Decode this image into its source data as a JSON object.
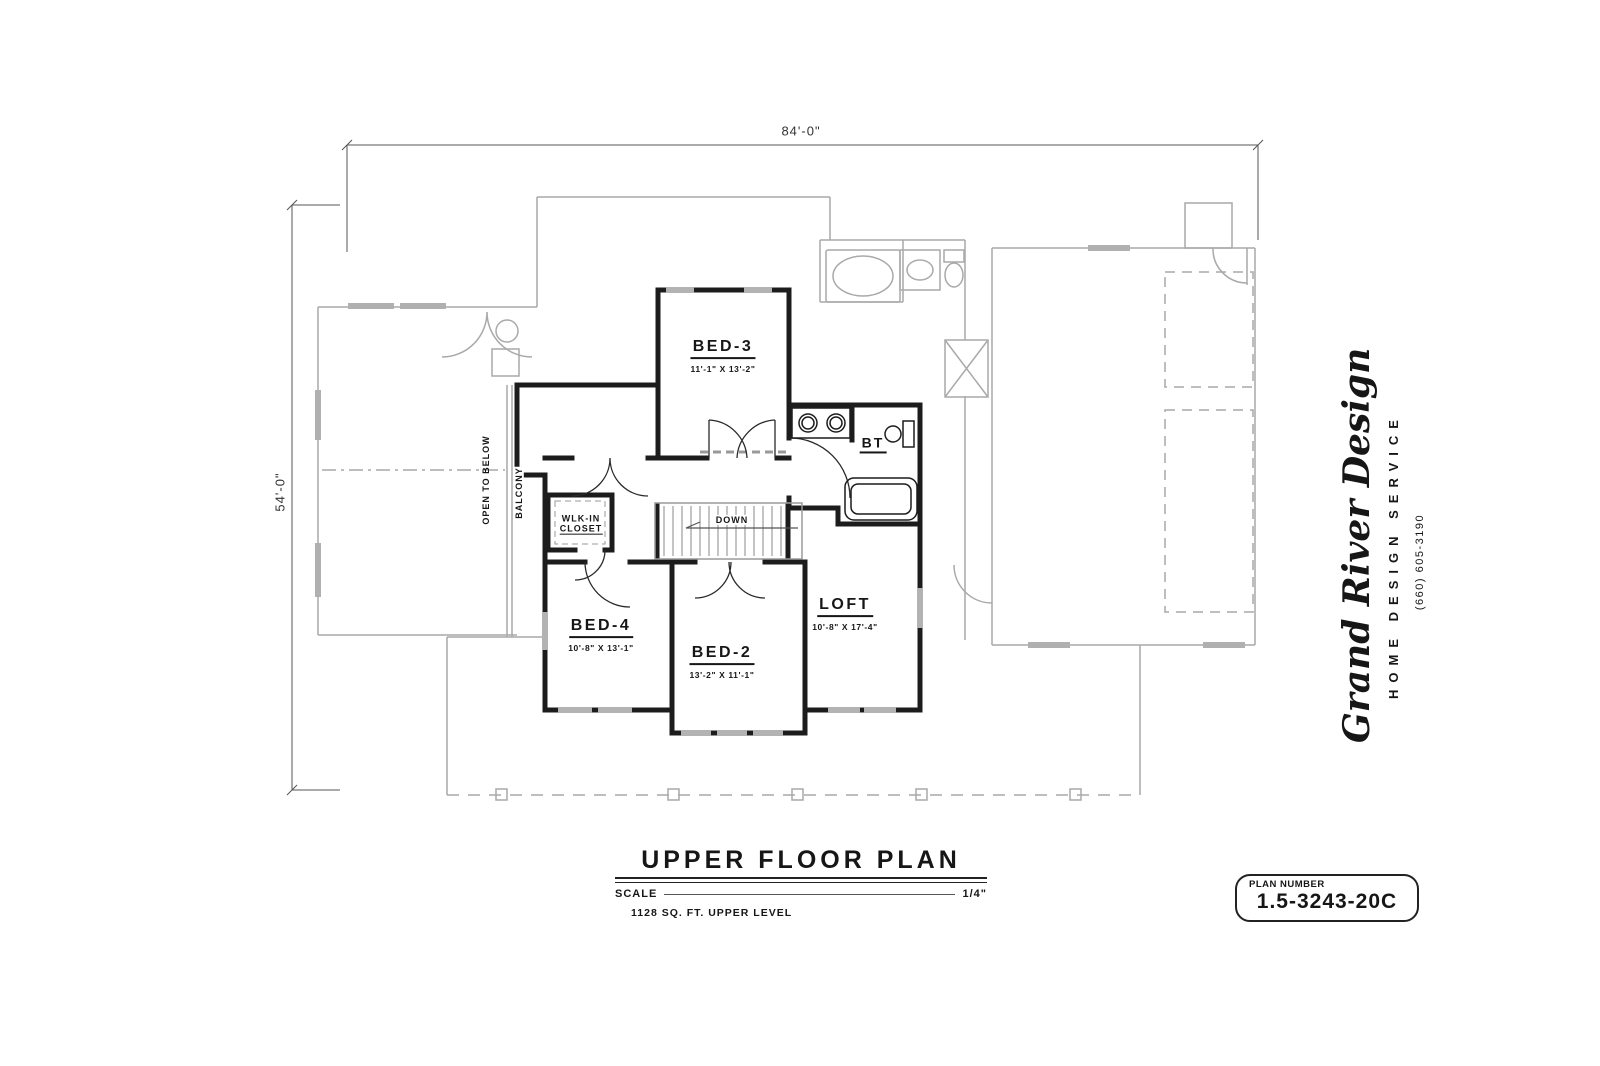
{
  "dimensions": {
    "width_label": "84'-0\"",
    "height_label": "54'-0\""
  },
  "rooms": {
    "bed3": {
      "label": "BED-3",
      "size": "11'-1\" X 13'-2\""
    },
    "bed4": {
      "label": "BED-4",
      "size": "10'-8\" X 13'-1\""
    },
    "bed2": {
      "label": "BED-2",
      "size": "13'-2\" X 11'-1\""
    },
    "loft": {
      "label": "LOFT",
      "size": "10'-8\" X 17'-4\""
    },
    "bath": {
      "label": "BT"
    },
    "closet": {
      "line1": "WLK-IN",
      "line2": "CLOSET"
    },
    "stairs": {
      "label": "DOWN"
    },
    "open_to_below": {
      "label": "OPEN TO BELOW"
    },
    "balcony": {
      "label": "BALCONY"
    }
  },
  "title_block": {
    "title": "UPPER FLOOR PLAN",
    "scale_label": "SCALE",
    "scale_value": "1/4\"",
    "area_note": "1128  SQ. FT.  UPPER LEVEL"
  },
  "plan_number_box": {
    "label": "PLAN  NUMBER",
    "number": "1.5-3243-20C"
  },
  "branding": {
    "company": "Grand River Design",
    "tagline": "HOME DESIGN SERVICE",
    "phone": "(660) 605-3190"
  },
  "colors": {
    "wall": "#1c1c1c",
    "background_lines": "#a9a9a9",
    "paper": "#ffffff",
    "text": "#161616"
  }
}
